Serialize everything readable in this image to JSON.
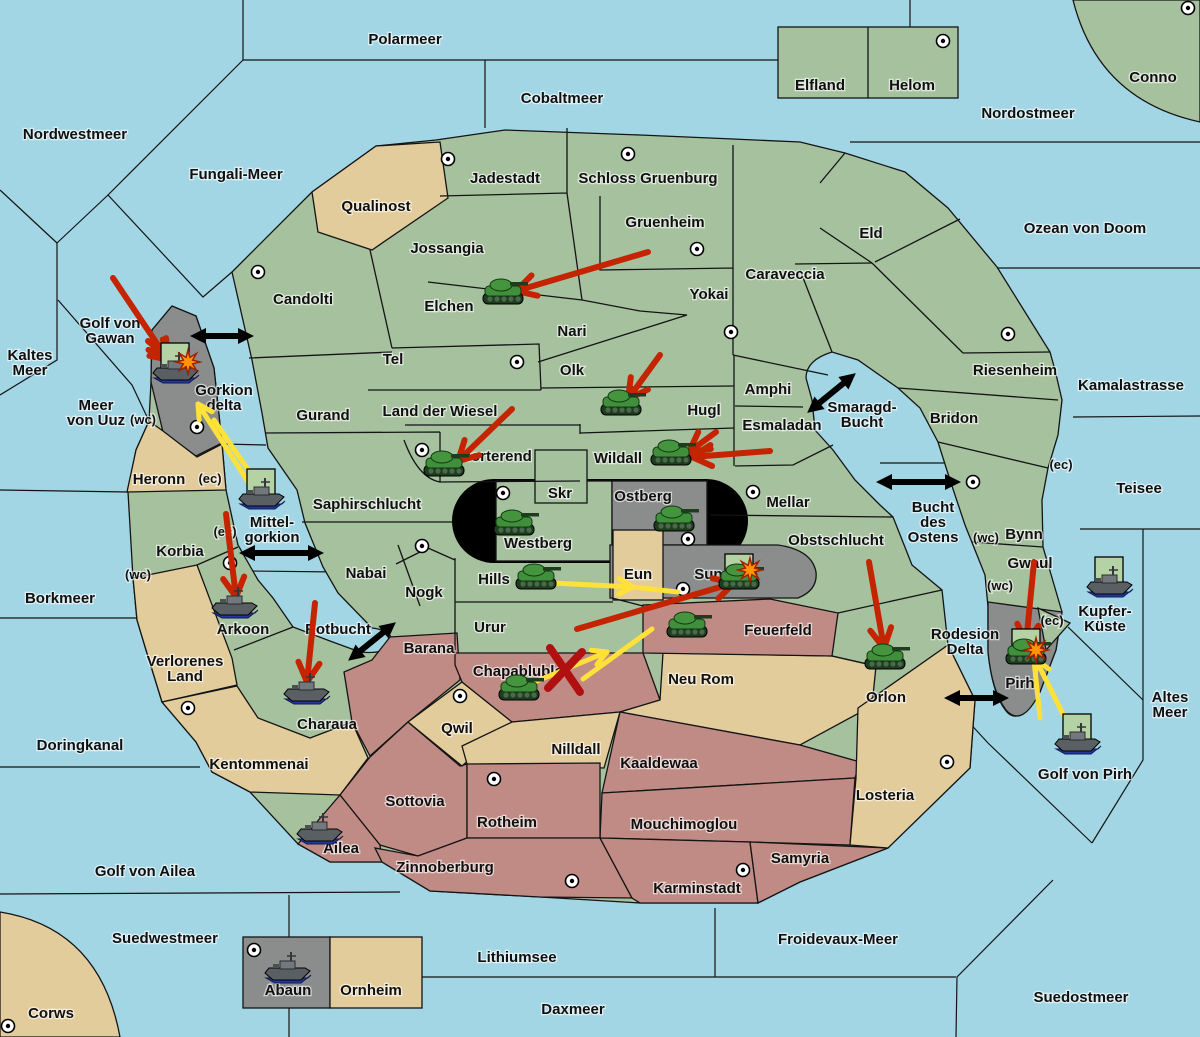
{
  "map": {
    "colors": {
      "sea": "#a2d6e4",
      "land_green": "#a6c19e",
      "land_tan": "#e3cc9c",
      "land_red": "#c08b85",
      "land_gray": "#8b8d8d",
      "capsule_black": "#000000",
      "unit_box": "#b5d2a4",
      "attack": "#c42400",
      "support": "#ffe13a",
      "strait": "#000000",
      "explosion": "#ff9500",
      "cut": "#b01010"
    },
    "labels": [
      {
        "id": "polarmeer",
        "x": 405,
        "y": 44,
        "lines": [
          "Polarmeer"
        ]
      },
      {
        "id": "cobaltmeer",
        "x": 562,
        "y": 103,
        "lines": [
          "Cobaltmeer"
        ]
      },
      {
        "id": "nordostmeer",
        "x": 1028,
        "y": 118,
        "lines": [
          "Nordostmeer"
        ]
      },
      {
        "id": "nordwestmeer",
        "x": 75,
        "y": 139,
        "lines": [
          "Nordwestmeer"
        ]
      },
      {
        "id": "fungali-meer",
        "x": 236,
        "y": 179,
        "lines": [
          "Fungali-Meer"
        ]
      },
      {
        "id": "ozean-von-doom",
        "x": 1085,
        "y": 233,
        "lines": [
          "Ozean von Doom"
        ]
      },
      {
        "id": "kaltes-meer",
        "x": 30,
        "y": 360,
        "lines": [
          "Kaltes",
          "Meer"
        ]
      },
      {
        "id": "golf-von-gawan",
        "x": 110,
        "y": 328,
        "lines": [
          "Golf von",
          "Gawan"
        ]
      },
      {
        "id": "meer-von-uuz",
        "x": 96,
        "y": 410,
        "lines": [
          "Meer",
          "von Uuz"
        ]
      },
      {
        "id": "gorkion-delta",
        "x": 224,
        "y": 395,
        "lines": [
          "Gorkion",
          "delta"
        ]
      },
      {
        "id": "kamalastrasse",
        "x": 1131,
        "y": 390,
        "lines": [
          "Kamalastrasse"
        ]
      },
      {
        "id": "smaragd-bucht",
        "x": 862,
        "y": 412,
        "lines": [
          "Smaragd-",
          "Bucht"
        ]
      },
      {
        "id": "teisee",
        "x": 1139,
        "y": 493,
        "lines": [
          "Teisee"
        ]
      },
      {
        "id": "mittelgorkion",
        "x": 272,
        "y": 527,
        "lines": [
          "Mittel-",
          "gorkion"
        ]
      },
      {
        "id": "bucht-des-ostens",
        "x": 933,
        "y": 512,
        "lines": [
          "Bucht",
          "des",
          "Ostens"
        ]
      },
      {
        "id": "borkmeer",
        "x": 60,
        "y": 603,
        "lines": [
          "Borkmeer"
        ]
      },
      {
        "id": "altes-meer",
        "x": 1170,
        "y": 702,
        "lines": [
          "Altes",
          "Meer"
        ]
      },
      {
        "id": "kupfer-kueste",
        "x": 1105,
        "y": 616,
        "lines": [
          "Kupfer-",
          "Küste"
        ]
      },
      {
        "id": "rotbucht",
        "x": 338,
        "y": 634,
        "lines": [
          "Rotbucht"
        ]
      },
      {
        "id": "rodesion-delta",
        "x": 965,
        "y": 639,
        "lines": [
          "Rodesion",
          "Delta"
        ]
      },
      {
        "id": "doringkanal",
        "x": 80,
        "y": 750,
        "lines": [
          "Doringkanal"
        ]
      },
      {
        "id": "golf-von-ailea",
        "x": 145,
        "y": 876,
        "lines": [
          "Golf von Ailea"
        ]
      },
      {
        "id": "golf-von-pirh",
        "x": 1085,
        "y": 779,
        "lines": [
          "Golf von Pirh"
        ]
      },
      {
        "id": "suedwestmeer",
        "x": 165,
        "y": 943,
        "lines": [
          "Suedwestmeer"
        ]
      },
      {
        "id": "lithiumsee",
        "x": 517,
        "y": 962,
        "lines": [
          "Lithiumsee"
        ]
      },
      {
        "id": "froidevaux-meer",
        "x": 838,
        "y": 944,
        "lines": [
          "Froidevaux-Meer"
        ]
      },
      {
        "id": "daxmeer",
        "x": 573,
        "y": 1014,
        "lines": [
          "Daxmeer"
        ]
      },
      {
        "id": "suedostmeer",
        "x": 1081,
        "y": 1002,
        "lines": [
          "Suedostmeer"
        ]
      },
      {
        "id": "corws",
        "x": 51,
        "y": 1018,
        "lines": [
          "Corws"
        ]
      },
      {
        "id": "elfland",
        "x": 820,
        "y": 90,
        "lines": [
          "Elfland"
        ]
      },
      {
        "id": "helom",
        "x": 912,
        "y": 90,
        "lines": [
          "Helom"
        ]
      },
      {
        "id": "conno",
        "x": 1153,
        "y": 82,
        "lines": [
          "Conno"
        ]
      },
      {
        "id": "qualinost",
        "x": 376,
        "y": 211,
        "lines": [
          "Qualinost"
        ]
      },
      {
        "id": "jadestadt",
        "x": 505,
        "y": 183,
        "lines": [
          "Jadestadt"
        ]
      },
      {
        "id": "schloss-gruenburg",
        "x": 648,
        "y": 183,
        "lines": [
          "Schloss Gruenburg"
        ]
      },
      {
        "id": "eld",
        "x": 871,
        "y": 238,
        "lines": [
          "Eld"
        ]
      },
      {
        "id": "gruenheim",
        "x": 665,
        "y": 227,
        "lines": [
          "Gruenheim"
        ]
      },
      {
        "id": "jossangia",
        "x": 447,
        "y": 253,
        "lines": [
          "Jossangia"
        ]
      },
      {
        "id": "caraveccia",
        "x": 785,
        "y": 279,
        "lines": [
          "Caraveccia"
        ]
      },
      {
        "id": "yokai",
        "x": 709,
        "y": 299,
        "lines": [
          "Yokai"
        ]
      },
      {
        "id": "candolti",
        "x": 303,
        "y": 304,
        "lines": [
          "Candolti"
        ]
      },
      {
        "id": "elchen",
        "x": 449,
        "y": 311,
        "lines": [
          "Elchen"
        ]
      },
      {
        "id": "nari",
        "x": 572,
        "y": 336,
        "lines": [
          "Nari"
        ]
      },
      {
        "id": "tel",
        "x": 393,
        "y": 364,
        "lines": [
          "Tel"
        ]
      },
      {
        "id": "olk",
        "x": 572,
        "y": 375,
        "lines": [
          "Olk"
        ]
      },
      {
        "id": "amphi",
        "x": 768,
        "y": 394,
        "lines": [
          "Amphi"
        ]
      },
      {
        "id": "riesenheim",
        "x": 1015,
        "y": 375,
        "lines": [
          "Riesenheim"
        ]
      },
      {
        "id": "hugl",
        "x": 704,
        "y": 415,
        "lines": [
          "Hugl"
        ]
      },
      {
        "id": "esmaladan",
        "x": 782,
        "y": 430,
        "lines": [
          "Esmaladan"
        ]
      },
      {
        "id": "bridon",
        "x": 954,
        "y": 423,
        "lines": [
          "Bridon"
        ]
      },
      {
        "id": "gurand",
        "x": 323,
        "y": 420,
        "lines": [
          "Gurand"
        ]
      },
      {
        "id": "land-der-wiesel",
        "x": 440,
        "y": 416,
        "lines": [
          "Land der Wiesel"
        ]
      },
      {
        "id": "heronn",
        "x": 159,
        "y": 484,
        "lines": [
          "Heronn"
        ]
      },
      {
        "id": "norterend",
        "x": 496,
        "y": 461,
        "lines": [
          "Norterend"
        ]
      },
      {
        "id": "wildall",
        "x": 618,
        "y": 463,
        "lines": [
          "Wildall"
        ]
      },
      {
        "id": "saphirschlucht",
        "x": 367,
        "y": 509,
        "lines": [
          "Saphirschlucht"
        ]
      },
      {
        "id": "skr",
        "x": 560,
        "y": 498,
        "lines": [
          "Skr"
        ]
      },
      {
        "id": "ostberg",
        "x": 643,
        "y": 501,
        "lines": [
          "Ostberg"
        ]
      },
      {
        "id": "mellar",
        "x": 788,
        "y": 507,
        "lines": [
          "Mellar"
        ]
      },
      {
        "id": "korbia",
        "x": 180,
        "y": 556,
        "lines": [
          "Korbia"
        ]
      },
      {
        "id": "westberg",
        "x": 538,
        "y": 548,
        "lines": [
          "Westberg"
        ]
      },
      {
        "id": "obstschlucht",
        "x": 836,
        "y": 545,
        "lines": [
          "Obstschlucht"
        ]
      },
      {
        "id": "bynn",
        "x": 1024,
        "y": 539,
        "lines": [
          "Bynn"
        ]
      },
      {
        "id": "gwaul",
        "x": 1030,
        "y": 568,
        "lines": [
          "Gwaul"
        ]
      },
      {
        "id": "nabai",
        "x": 366,
        "y": 578,
        "lines": [
          "Nabai"
        ]
      },
      {
        "id": "nogk",
        "x": 424,
        "y": 597,
        "lines": [
          "Nogk"
        ]
      },
      {
        "id": "hills",
        "x": 494,
        "y": 584,
        "lines": [
          "Hills"
        ]
      },
      {
        "id": "eun",
        "x": 638,
        "y": 579,
        "lines": [
          "Eun"
        ]
      },
      {
        "id": "sund",
        "x": 713,
        "y": 579,
        "lines": [
          "Sund"
        ]
      },
      {
        "id": "arkoon",
        "x": 243,
        "y": 634,
        "lines": [
          "Arkoon"
        ]
      },
      {
        "id": "urur",
        "x": 490,
        "y": 632,
        "lines": [
          "Urur"
        ]
      },
      {
        "id": "feuerfeld",
        "x": 778,
        "y": 635,
        "lines": [
          "Feuerfeld"
        ]
      },
      {
        "id": "verlorenes-land",
        "x": 185,
        "y": 666,
        "lines": [
          "Verlorenes",
          "Land"
        ]
      },
      {
        "id": "barana",
        "x": 429,
        "y": 653,
        "lines": [
          "Barana"
        ]
      },
      {
        "id": "chapablublek",
        "x": 522,
        "y": 676,
        "lines": [
          "Chapablublek"
        ]
      },
      {
        "id": "neu-rom",
        "x": 701,
        "y": 684,
        "lines": [
          "Neu Rom"
        ]
      },
      {
        "id": "orlon",
        "x": 886,
        "y": 702,
        "lines": [
          "Orlon"
        ]
      },
      {
        "id": "pirh",
        "x": 1020,
        "y": 688,
        "lines": [
          "Pirh"
        ]
      },
      {
        "id": "charaua",
        "x": 327,
        "y": 729,
        "lines": [
          "Charaua"
        ]
      },
      {
        "id": "qwil",
        "x": 457,
        "y": 733,
        "lines": [
          "Qwil"
        ]
      },
      {
        "id": "nilldall",
        "x": 576,
        "y": 754,
        "lines": [
          "Nilldall"
        ]
      },
      {
        "id": "kaaldewaa",
        "x": 659,
        "y": 768,
        "lines": [
          "Kaaldewaa"
        ]
      },
      {
        "id": "losteria",
        "x": 885,
        "y": 800,
        "lines": [
          "Losteria"
        ]
      },
      {
        "id": "kentommenai",
        "x": 259,
        "y": 769,
        "lines": [
          "Kentommenai"
        ]
      },
      {
        "id": "sottovia",
        "x": 415,
        "y": 806,
        "lines": [
          "Sottovia"
        ]
      },
      {
        "id": "rotheim",
        "x": 507,
        "y": 827,
        "lines": [
          "Rotheim"
        ]
      },
      {
        "id": "mouchimoglou",
        "x": 684,
        "y": 829,
        "lines": [
          "Mouchimoglou"
        ]
      },
      {
        "id": "ailea",
        "x": 341,
        "y": 853,
        "lines": [
          "Ailea"
        ]
      },
      {
        "id": "samyria",
        "x": 800,
        "y": 863,
        "lines": [
          "Samyria"
        ]
      },
      {
        "id": "zinnoberburg",
        "x": 445,
        "y": 872,
        "lines": [
          "Zinnoberburg"
        ]
      },
      {
        "id": "karminstadt",
        "x": 697,
        "y": 893,
        "lines": [
          "Karminstadt"
        ]
      },
      {
        "id": "abaun",
        "x": 288,
        "y": 995,
        "lines": [
          "Abaun"
        ]
      },
      {
        "id": "ornheim",
        "x": 371,
        "y": 995,
        "lines": [
          "Ornheim"
        ]
      }
    ],
    "coast_markers": [
      {
        "text": "(wc)",
        "x": 143,
        "y": 424
      },
      {
        "text": "(ec)",
        "x": 210,
        "y": 483
      },
      {
        "text": "(ec)",
        "x": 225,
        "y": 536
      },
      {
        "text": "(wc)",
        "x": 138,
        "y": 579
      },
      {
        "text": "(ec)",
        "x": 1061,
        "y": 469
      },
      {
        "text": "(wc)",
        "x": 986,
        "y": 542
      },
      {
        "text": "(wc)",
        "x": 1000,
        "y": 590
      },
      {
        "text": "(ec)",
        "x": 1052,
        "y": 625
      }
    ],
    "supply_centers": [
      {
        "x": 258,
        "y": 272
      },
      {
        "x": 448,
        "y": 159
      },
      {
        "x": 628,
        "y": 154
      },
      {
        "x": 697,
        "y": 249
      },
      {
        "x": 943,
        "y": 41
      },
      {
        "x": 1188,
        "y": 8
      },
      {
        "x": 731,
        "y": 332
      },
      {
        "x": 517,
        "y": 362
      },
      {
        "x": 422,
        "y": 450
      },
      {
        "x": 1008,
        "y": 334
      },
      {
        "x": 973,
        "y": 482
      },
      {
        "x": 503,
        "y": 493
      },
      {
        "x": 688,
        "y": 539
      },
      {
        "x": 753,
        "y": 492
      },
      {
        "x": 683,
        "y": 589
      },
      {
        "x": 197,
        "y": 427
      },
      {
        "x": 230,
        "y": 563
      },
      {
        "x": 188,
        "y": 708
      },
      {
        "x": 422,
        "y": 546
      },
      {
        "x": 460,
        "y": 696
      },
      {
        "x": 494,
        "y": 779
      },
      {
        "x": 572,
        "y": 881
      },
      {
        "x": 743,
        "y": 870
      },
      {
        "x": 947,
        "y": 762
      },
      {
        "x": 8,
        "y": 1026
      },
      {
        "x": 254,
        "y": 950
      }
    ],
    "units": [
      {
        "type": "army",
        "x": 504,
        "y": 296,
        "boxed": false
      },
      {
        "type": "army",
        "x": 622,
        "y": 407,
        "boxed": false
      },
      {
        "type": "army",
        "x": 445,
        "y": 468,
        "boxed": false
      },
      {
        "type": "army",
        "x": 672,
        "y": 457,
        "boxed": false
      },
      {
        "type": "army",
        "x": 515,
        "y": 527,
        "boxed": false
      },
      {
        "type": "army",
        "x": 675,
        "y": 523,
        "boxed": false
      },
      {
        "type": "army",
        "x": 537,
        "y": 581,
        "boxed": false
      },
      {
        "type": "army",
        "x": 740,
        "y": 581,
        "boxed": true
      },
      {
        "type": "army",
        "x": 688,
        "y": 629,
        "boxed": false
      },
      {
        "type": "army",
        "x": 520,
        "y": 692,
        "boxed": false
      },
      {
        "type": "army",
        "x": 886,
        "y": 661,
        "boxed": false
      },
      {
        "type": "army",
        "x": 1027,
        "y": 656,
        "boxed": true
      },
      {
        "type": "fleet",
        "x": 176,
        "y": 370,
        "boxed": true
      },
      {
        "type": "fleet",
        "x": 262,
        "y": 496,
        "boxed": true
      },
      {
        "type": "fleet",
        "x": 235,
        "y": 605,
        "boxed": false
      },
      {
        "type": "fleet",
        "x": 307,
        "y": 691,
        "boxed": false
      },
      {
        "type": "fleet",
        "x": 320,
        "y": 831,
        "boxed": false
      },
      {
        "type": "fleet",
        "x": 288,
        "y": 970,
        "boxed": false
      },
      {
        "type": "fleet",
        "x": 1110,
        "y": 584,
        "boxed": true
      },
      {
        "type": "fleet",
        "x": 1078,
        "y": 741,
        "boxed": true
      }
    ],
    "attack_arrows": [
      {
        "x1": 648,
        "y1": 252,
        "x2": 516,
        "y2": 291
      },
      {
        "x1": 660,
        "y1": 355,
        "x2": 628,
        "y2": 399
      },
      {
        "x1": 512,
        "y1": 409,
        "x2": 458,
        "y2": 461
      },
      {
        "x1": 770,
        "y1": 451,
        "x2": 692,
        "y2": 457
      },
      {
        "x1": 716,
        "y1": 432,
        "x2": 689,
        "y2": 452
      },
      {
        "x1": 113,
        "y1": 278,
        "x2": 168,
        "y2": 360
      },
      {
        "x1": 148,
        "y1": 341,
        "x2": 171,
        "y2": 360
      },
      {
        "x1": 226,
        "y1": 514,
        "x2": 236,
        "y2": 597
      },
      {
        "x1": 315,
        "y1": 603,
        "x2": 307,
        "y2": 682
      },
      {
        "x1": 577,
        "y1": 629,
        "x2": 734,
        "y2": 583
      },
      {
        "x1": 869,
        "y1": 562,
        "x2": 884,
        "y2": 648
      },
      {
        "x1": 1034,
        "y1": 562,
        "x2": 1026,
        "y2": 644
      }
    ],
    "support_arrows": [
      {
        "x1": 252,
        "y1": 488,
        "x2": 198,
        "y2": 404
      },
      {
        "x1": 552,
        "y1": 583,
        "x2": 633,
        "y2": 587
      },
      {
        "x1": 520,
        "y1": 688,
        "x2": 607,
        "y2": 652
      },
      {
        "x1": 1072,
        "y1": 732,
        "x2": 1036,
        "y2": 660
      }
    ],
    "support_lines": [
      {
        "x1": 262,
        "y1": 490,
        "x2": 214,
        "y2": 420
      },
      {
        "x1": 633,
        "y1": 587,
        "x2": 678,
        "y2": 592
      },
      {
        "x1": 583,
        "y1": 679,
        "x2": 652,
        "y2": 629
      },
      {
        "x1": 1040,
        "y1": 718,
        "x2": 1034,
        "y2": 660
      }
    ],
    "strait_arrows": [
      {
        "x1": 204,
        "y1": 336,
        "x2": 240,
        "y2": 336
      },
      {
        "x1": 253,
        "y1": 553,
        "x2": 310,
        "y2": 553
      },
      {
        "x1": 359,
        "y1": 652,
        "x2": 385,
        "y2": 631
      },
      {
        "x1": 818,
        "y1": 404,
        "x2": 845,
        "y2": 382
      },
      {
        "x1": 890,
        "y1": 482,
        "x2": 947,
        "y2": 482
      },
      {
        "x1": 958,
        "y1": 698,
        "x2": 995,
        "y2": 698
      }
    ],
    "explosions": [
      {
        "x": 188,
        "y": 362
      },
      {
        "x": 750,
        "y": 570
      },
      {
        "x": 1036,
        "y": 650
      }
    ],
    "cut_marks": [
      {
        "x": 565,
        "y": 670
      }
    ]
  }
}
